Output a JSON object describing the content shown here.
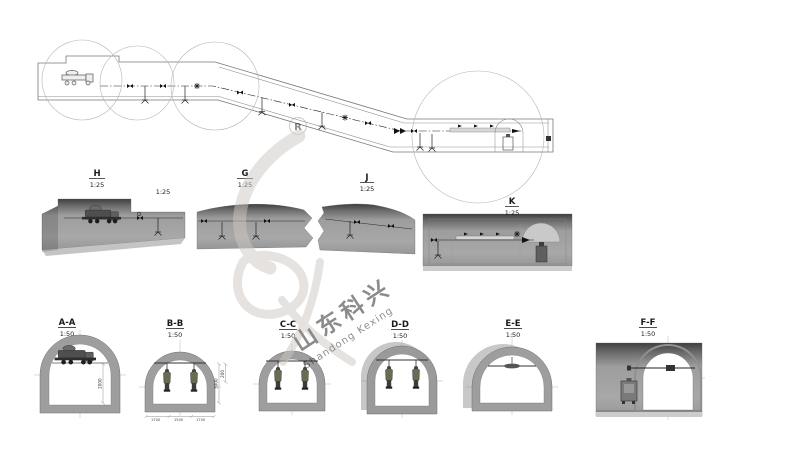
{
  "watermark": {
    "registered_letter": "R",
    "brand_cn": "山东科兴",
    "brand_en": "Shandong Kexing"
  },
  "profiles": {
    "h": {
      "label": "H",
      "scale": "1:25",
      "side_scale": "1:25"
    },
    "g": {
      "label": "G",
      "scale": "1:25"
    },
    "j": {
      "label": "J",
      "scale": "1:25"
    },
    "k": {
      "label": "K",
      "scale": "1:25"
    }
  },
  "cross_sections": [
    {
      "label": "A-A",
      "scale": "1:50",
      "dim_height": "2000"
    },
    {
      "label": "B-B",
      "scale": "1:50",
      "dim_right_a": "3000",
      "dim_right_b": "200",
      "dim_bottom_a": "1700",
      "dim_bottom_b": "1500",
      "dim_bottom_c": "1700"
    },
    {
      "label": "C-C",
      "scale": "1:50"
    },
    {
      "label": "D-D",
      "scale": "1:50"
    },
    {
      "label": "E-E",
      "scale": "1:50"
    },
    {
      "label": "F-F",
      "scale": "1:50"
    }
  ]
}
